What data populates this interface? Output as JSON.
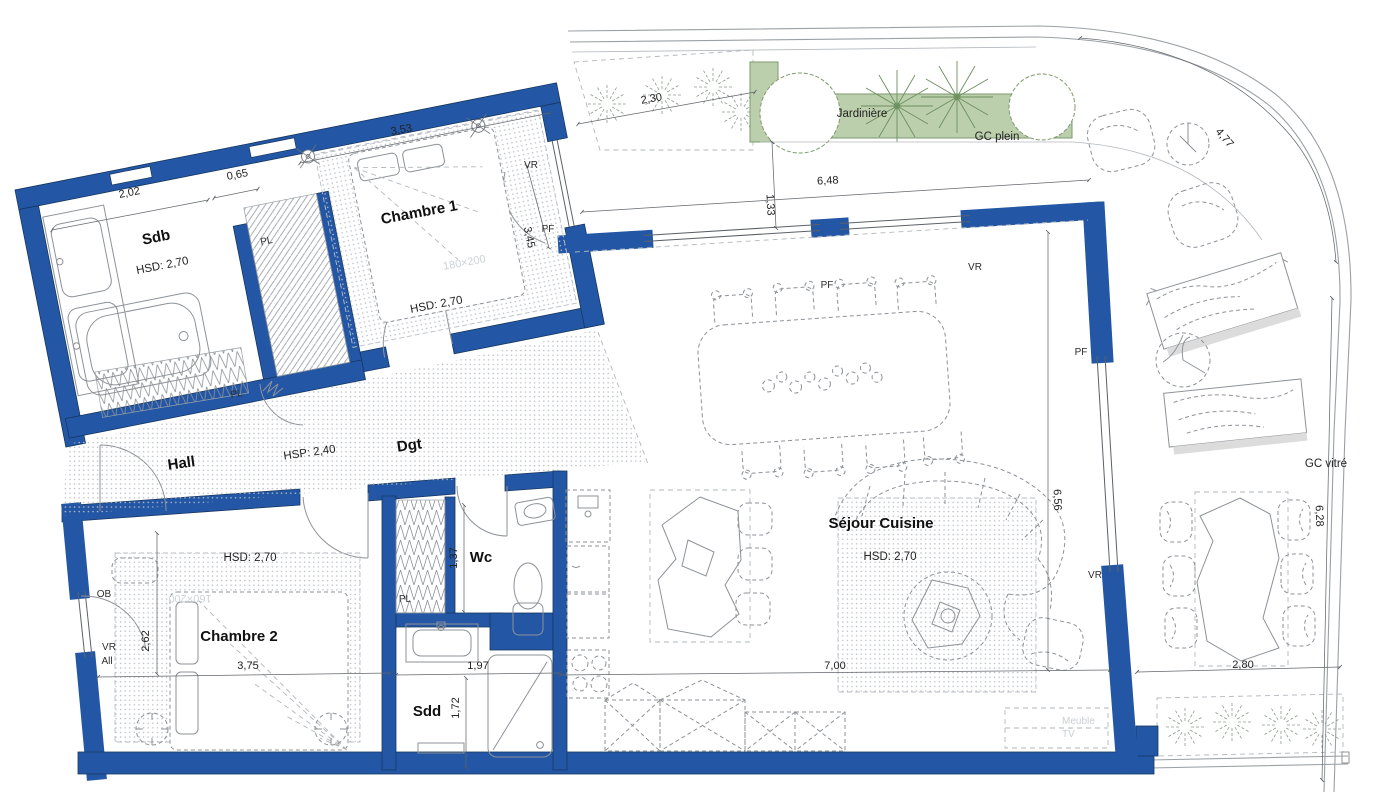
{
  "colors": {
    "wall": "#2357a5",
    "planter_fill": "#bccfad",
    "planter_stroke": "#7d9a6e",
    "line_gray": "#8d9298",
    "dim_gray": "#63676c",
    "faint_text": "#c9ced3"
  },
  "rooms": [
    {
      "name": "Sdb",
      "ceiling": "HSD: 2,70"
    },
    {
      "name": "Chambre 1",
      "ceiling": "HSD: 2,70",
      "bed_size": "180×200"
    },
    {
      "name": "Hall"
    },
    {
      "name": "Dgt",
      "ceiling": "HSP: 2,40"
    },
    {
      "name": "Chambre 2",
      "ceiling": "HSD: 2,70",
      "bed_size": "160×200"
    },
    {
      "name": "Wc"
    },
    {
      "name": "Sdd"
    },
    {
      "name": "Séjour Cuisine",
      "ceiling": "HSD: 2,70"
    }
  ],
  "outdoor": {
    "jardiniere": "Jardinière",
    "gc_plein": "GC plein",
    "gc_vitre": "GC vitré"
  },
  "openings": {
    "vr": "VR",
    "pf": "PF",
    "pl": "PL",
    "ob": "OB",
    "all": "All"
  },
  "furniture": {
    "meuble_tv_line1": "Meuble",
    "meuble_tv_line2": "TV"
  },
  "dimensions": {
    "sdb_width": "2,02",
    "sdb_door": "0,65",
    "chambre1_width": "3,53",
    "terrace_walkway": "2,30",
    "terrace_top_length": "6,48",
    "terrace_top_depth": "1,33",
    "terrace_curve": "4,77",
    "chambre1_window": "3,45",
    "chambre2_depth": "2,62",
    "chambre2_width": "3,75",
    "wc_width": "1,37",
    "sdd_width": "1,97",
    "sdd_depth": "1,72",
    "sejour_width": "7,00",
    "sejour_depth": "6,56",
    "terrace_right_length": "6,28",
    "terrace_bottom_width": "2,80"
  }
}
